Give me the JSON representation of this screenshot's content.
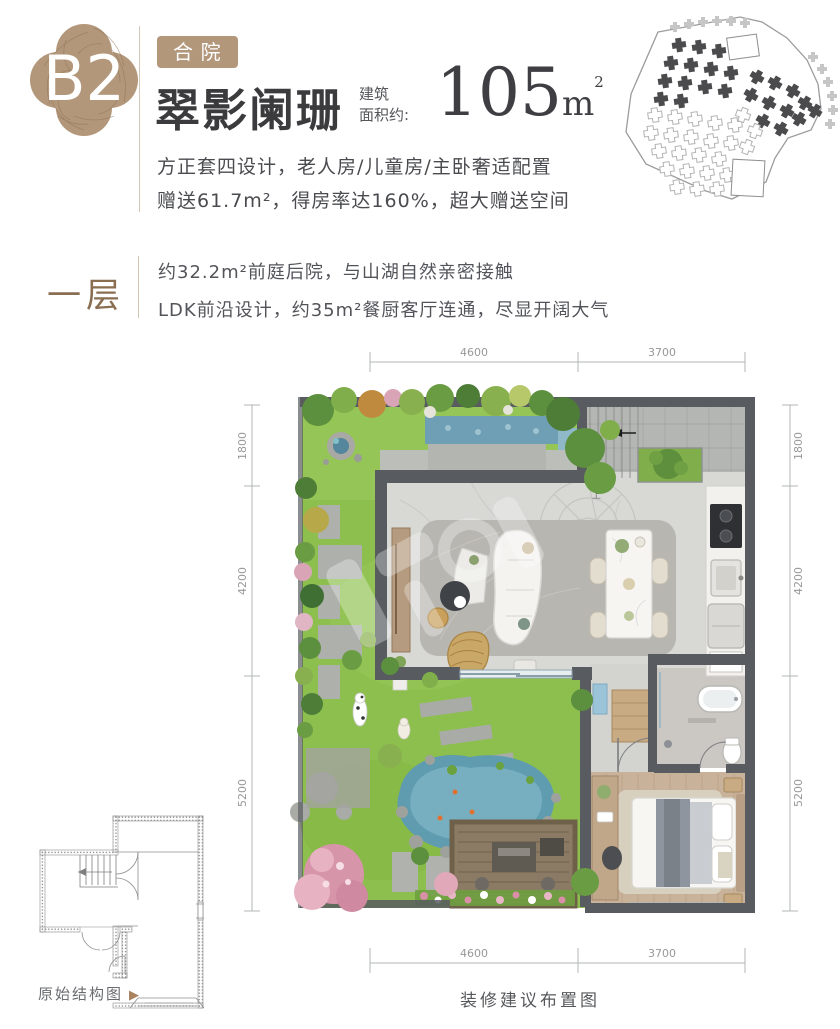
{
  "colors": {
    "accent_tan": "#b2977b",
    "brown": "#8a6e52",
    "title_dark": "#3b3b3e",
    "body": "#4a4b4f",
    "dim_gray": "#97989a"
  },
  "header": {
    "badge": "B2",
    "tag": "合院",
    "title": "翠影阑珊",
    "area_label_line1": "建筑",
    "area_label_line2": "面积约:",
    "area_value": "105",
    "area_unit": "m",
    "area_sup": "2",
    "desc_line1": "方正套四设计，老人房/儿童房/主卧奢适配置",
    "desc_line2": "赠送61.7m²，得房率达160%，超大赠送空间"
  },
  "floor_section": {
    "label": "一层",
    "line1": "约32.2m²前庭后院，与山湖自然亲密接触",
    "line2": "LDK前沿设计，约35m²餐厨客厅连通，尽显开阔大气"
  },
  "floor_plan": {
    "dim_top_left": "4600",
    "dim_top_right": "3700",
    "dim_bottom_left": "4600",
    "dim_bottom_right": "3700",
    "dim_left_1": "1800",
    "dim_left_2": "4200",
    "dim_left_3": "5200",
    "dim_right_1": "1800",
    "dim_right_2": "4200",
    "dim_right_3": "5200",
    "stair_label": "上",
    "caption": "装修建议布置图"
  },
  "structure_plan": {
    "label": "原始结构图",
    "arrow_icon": "▶"
  },
  "site_plan": {
    "dark": [
      [
        60,
        26,
        -8
      ],
      [
        80,
        28,
        -8
      ],
      [
        100,
        32,
        -8
      ],
      [
        52,
        44,
        -8
      ],
      [
        72,
        46,
        -8
      ],
      [
        92,
        50,
        -8
      ],
      [
        112,
        54,
        -8
      ],
      [
        46,
        62,
        -8
      ],
      [
        66,
        64,
        -8
      ],
      [
        86,
        68,
        -8
      ],
      [
        106,
        72,
        -8
      ],
      [
        42,
        80,
        -8
      ],
      [
        62,
        82,
        -8
      ],
      [
        138,
        58,
        30
      ],
      [
        156,
        64,
        30
      ],
      [
        174,
        72,
        30
      ],
      [
        132,
        76,
        30
      ],
      [
        150,
        84,
        30
      ],
      [
        168,
        92,
        30
      ],
      [
        186,
        84,
        30
      ],
      [
        144,
        102,
        30
      ],
      [
        162,
        110,
        30
      ],
      [
        180,
        100,
        30
      ],
      [
        196,
        92,
        30
      ]
    ],
    "light": [
      [
        36,
        96,
        -8
      ],
      [
        56,
        98,
        -8
      ],
      [
        76,
        100,
        -8
      ],
      [
        96,
        104,
        -8
      ],
      [
        116,
        106,
        -8
      ],
      [
        32,
        114,
        -8
      ],
      [
        52,
        116,
        -8
      ],
      [
        72,
        118,
        -8
      ],
      [
        92,
        122,
        -8
      ],
      [
        112,
        124,
        -8
      ],
      [
        40,
        132,
        -8
      ],
      [
        60,
        134,
        -8
      ],
      [
        80,
        136,
        -8
      ],
      [
        100,
        140,
        -8
      ],
      [
        48,
        150,
        -8
      ],
      [
        68,
        152,
        -8
      ],
      [
        88,
        154,
        -8
      ],
      [
        108,
        156,
        -8
      ],
      [
        58,
        168,
        -8
      ],
      [
        78,
        170,
        -8
      ],
      [
        98,
        170,
        -8
      ],
      [
        124,
        96,
        20
      ],
      [
        136,
        112,
        20
      ],
      [
        128,
        128,
        20
      ]
    ],
    "edge": [
      [
        58,
        10
      ],
      [
        72,
        7
      ],
      [
        86,
        5
      ],
      [
        100,
        4
      ],
      [
        114,
        4
      ],
      [
        128,
        6
      ],
      [
        196,
        40
      ],
      [
        205,
        52
      ],
      [
        211,
        65
      ],
      [
        215,
        79
      ],
      [
        216,
        93
      ],
      [
        213,
        107
      ]
    ]
  }
}
